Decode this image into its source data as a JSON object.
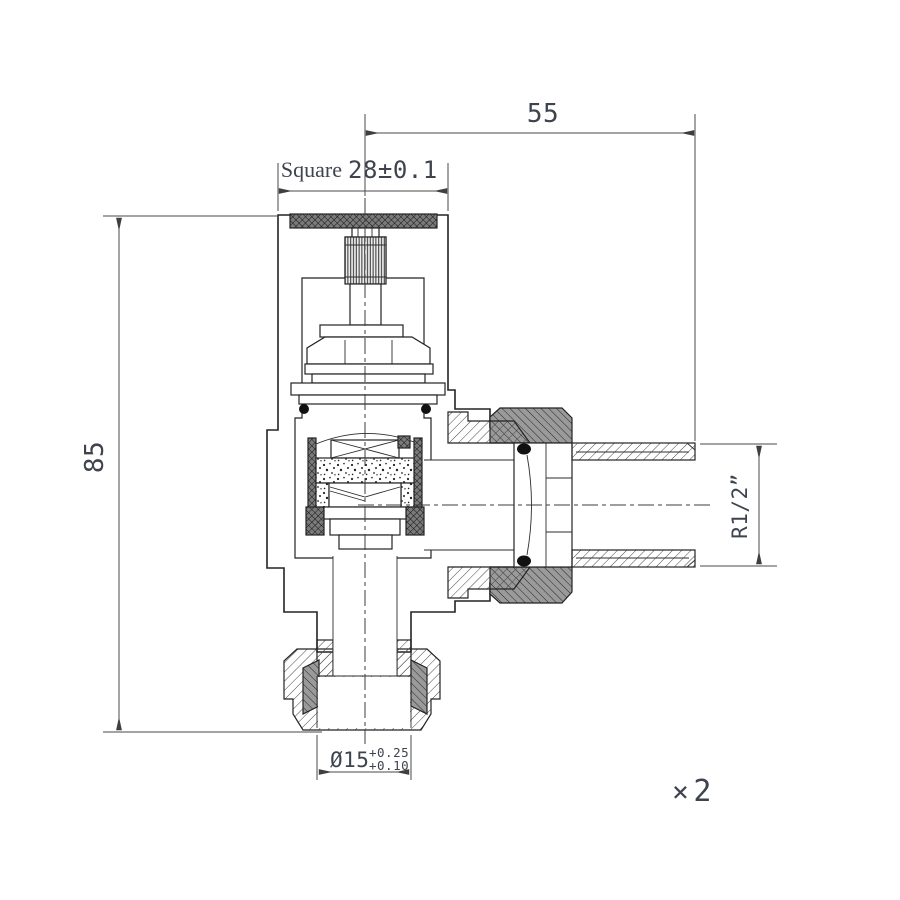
{
  "drawing": {
    "type": "valve-cross-section",
    "dimensions": {
      "width_top": "55",
      "square_prefix": "Square",
      "square_value": "28±0.1",
      "height_left": "85",
      "thread_right": "R1/2”",
      "dia_bottom": "Ø15",
      "dia_tol_upper": "+0.25",
      "dia_tol_lower": "+0.10"
    },
    "quantity": {
      "symbol": "×",
      "count": "2"
    },
    "colors": {
      "background": "#ffffff",
      "outline": "#232323",
      "dimension_line": "#4a4a4a",
      "text": "#3e434e",
      "dark_cap_fill": "#7a7a7a",
      "union_nut_fill": "#979797"
    }
  }
}
